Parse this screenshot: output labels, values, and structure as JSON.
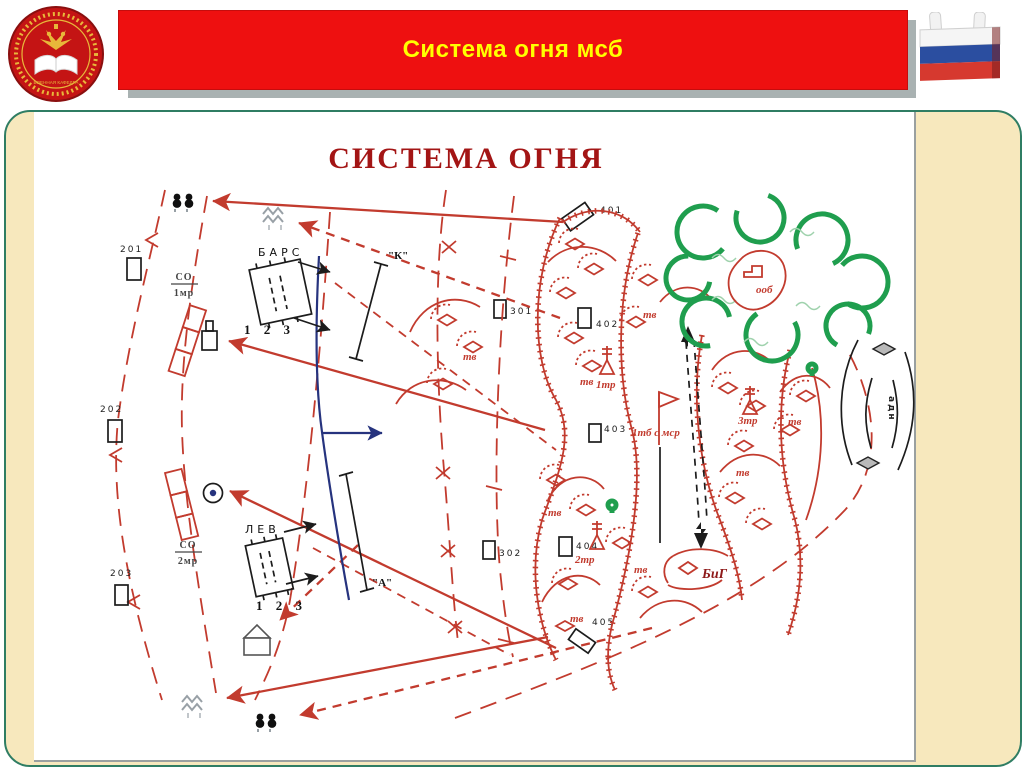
{
  "header": {
    "title": "Система огня мсб",
    "emblem_caption": "ВОЕННАЯ КАФЕДРА"
  },
  "diagram": {
    "title": "СИСТЕМА ОГНЯ",
    "ref_points": [
      "201",
      "202",
      "203",
      "301",
      "302",
      "401",
      "402",
      "403",
      "404",
      "405"
    ],
    "fire_concentrations": [
      {
        "top": "СО",
        "bottom": "1мр"
      },
      {
        "top": "СО",
        "bottom": "2мр"
      }
    ],
    "fire_sectors": [
      {
        "name": "БАРС",
        "numbers": "1 2 3"
      },
      {
        "name": "ЛЕВ",
        "numbers": "1 2 3"
      }
    ],
    "fire_lines": [
      {
        "name": "\"К\""
      },
      {
        "name": "\"А\""
      }
    ],
    "labels": {
      "tank_platoon": "тв",
      "company1": "1тр",
      "company2": "2тр",
      "company3": "3тр",
      "battalion": "1тб с мср",
      "armor_group": "БиГ",
      "object": "ооб",
      "artillery_battalion": "адн"
    },
    "colors": {
      "map_red": "#c23b2e",
      "navy": "#26337e",
      "forest_green": "#1f9e4e",
      "banner_red": "#ee1010",
      "banner_text": "#ffff00",
      "panel_bg": "#f7e8bd",
      "panel_border": "#2f7d63",
      "title_red": "#a31515"
    }
  }
}
